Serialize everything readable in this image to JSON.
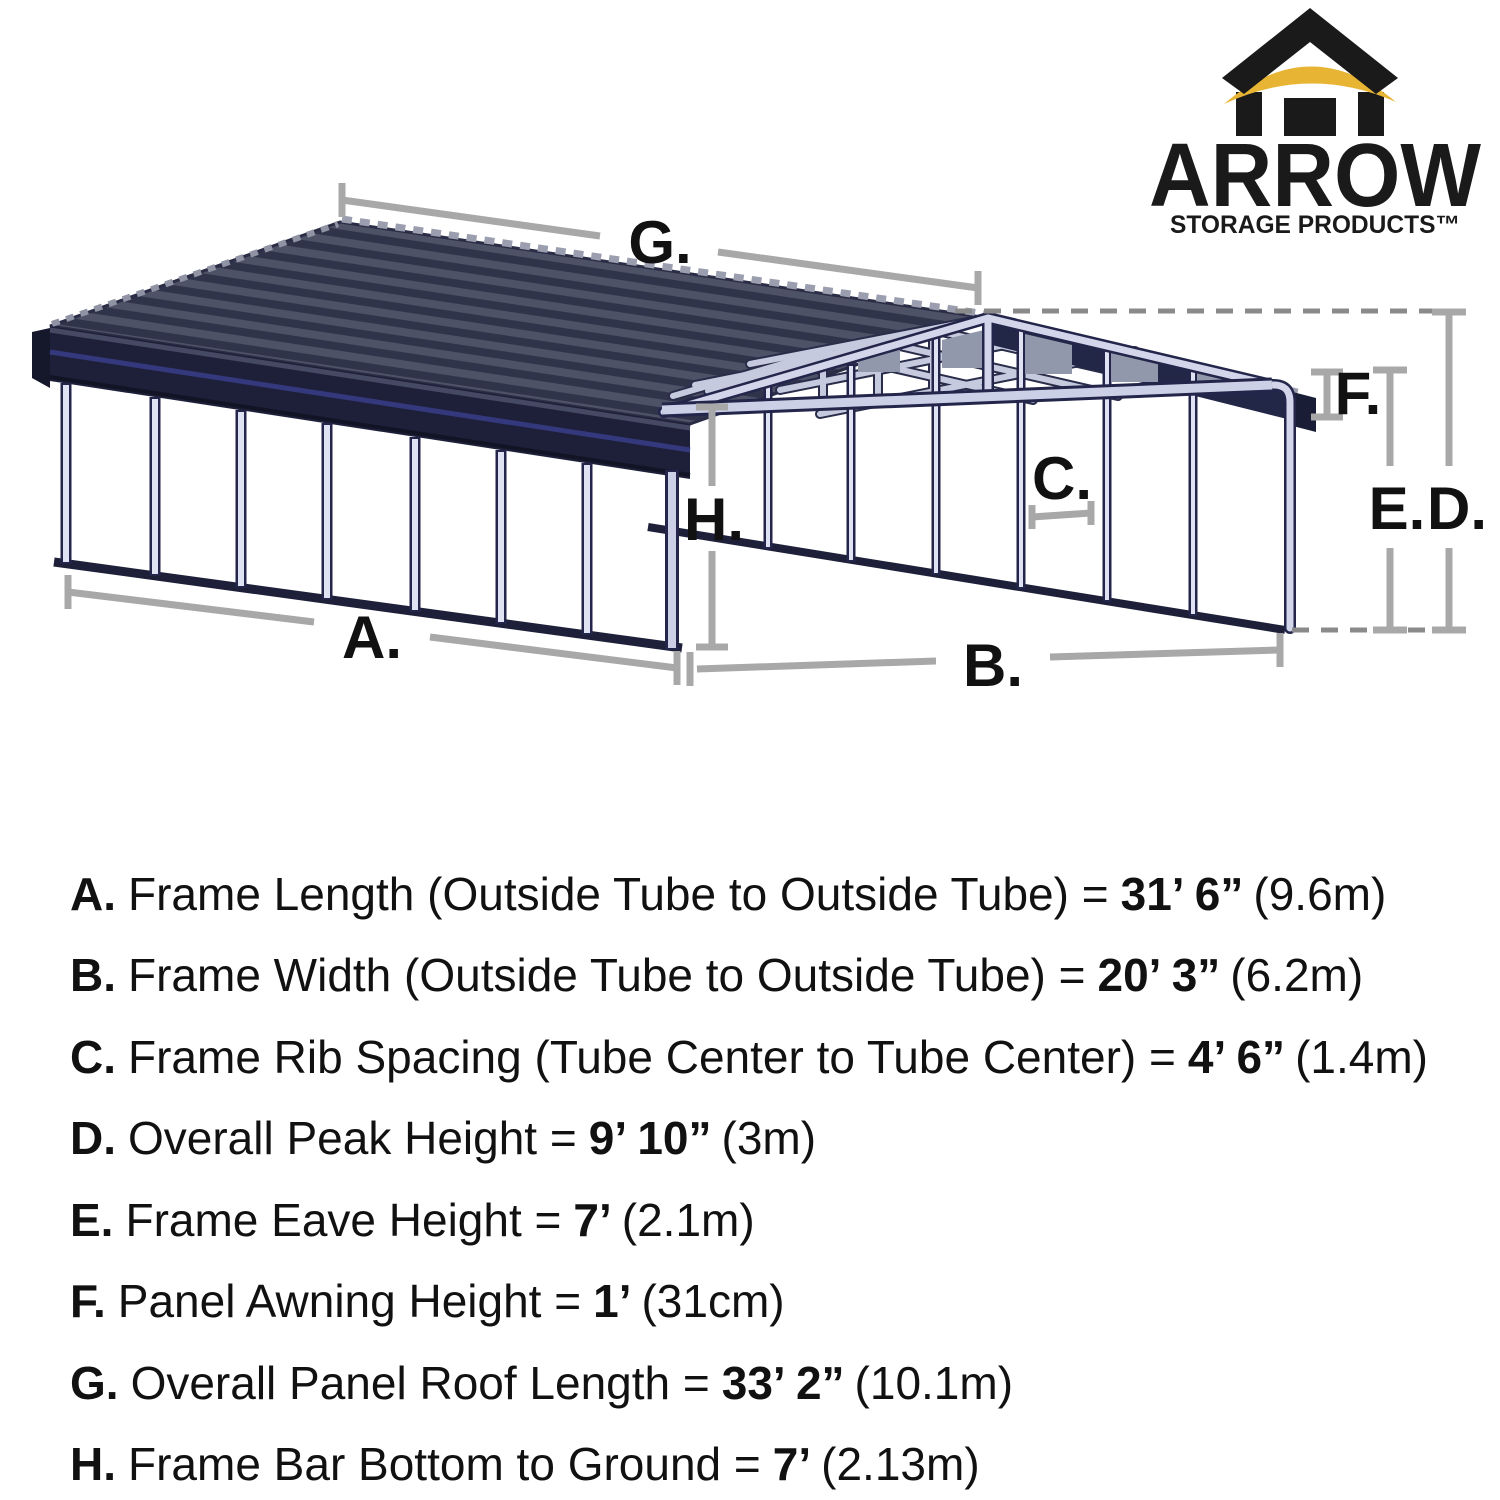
{
  "logo": {
    "brand": "ARROW",
    "tagline": "STORAGE PRODUCTS™"
  },
  "diagram": {
    "labels": {
      "a": "A.",
      "b": "B.",
      "c": "C.",
      "d": "D.",
      "e": "E.",
      "f": "F.",
      "g": "G.",
      "h": "H."
    }
  },
  "specs": [
    {
      "key": "A.",
      "desc": "Frame Length (Outside Tube to Outside Tube) =",
      "value": "31’ 6”",
      "metric": "(9.6m)"
    },
    {
      "key": "B.",
      "desc": "Frame Width (Outside Tube to Outside Tube) =",
      "value": "20’ 3”",
      "metric": "(6.2m)"
    },
    {
      "key": "C.",
      "desc": "Frame Rib Spacing (Tube Center to Tube Center) =",
      "value": "4’ 6”",
      "metric": "(1.4m)"
    },
    {
      "key": "D.",
      "desc": "Overall Peak Height =",
      "value": "9’ 10”",
      "metric": "(3m)"
    },
    {
      "key": "E.",
      "desc": "Frame Eave Height =",
      "value": "7’",
      "metric": "(2.1m)"
    },
    {
      "key": "F.",
      "desc": "Panel Awning Height =",
      "value": "1’",
      "metric": "(31cm)"
    },
    {
      "key": "G.",
      "desc": "Overall Panel Roof Length =",
      "value": "33’ 2”",
      "metric": "(10.1m)"
    },
    {
      "key": "H.",
      "desc": "Frame Bar Bottom to Ground =",
      "value": "7’",
      "metric": "(2.13m)"
    }
  ],
  "colors": {
    "roof_dark": "#30344a",
    "roof_mid": "#4e5266",
    "roof_serration": "#9b9eae",
    "navy_trim": "#1d2038",
    "blue_stripe": "#34387c",
    "frame_lavender": "#ccd0e6",
    "gusset_gray": "#9298ab",
    "dimension_gray": "#a8a8a8",
    "logo_yellow": "#e8b433",
    "text_black": "#111111"
  }
}
